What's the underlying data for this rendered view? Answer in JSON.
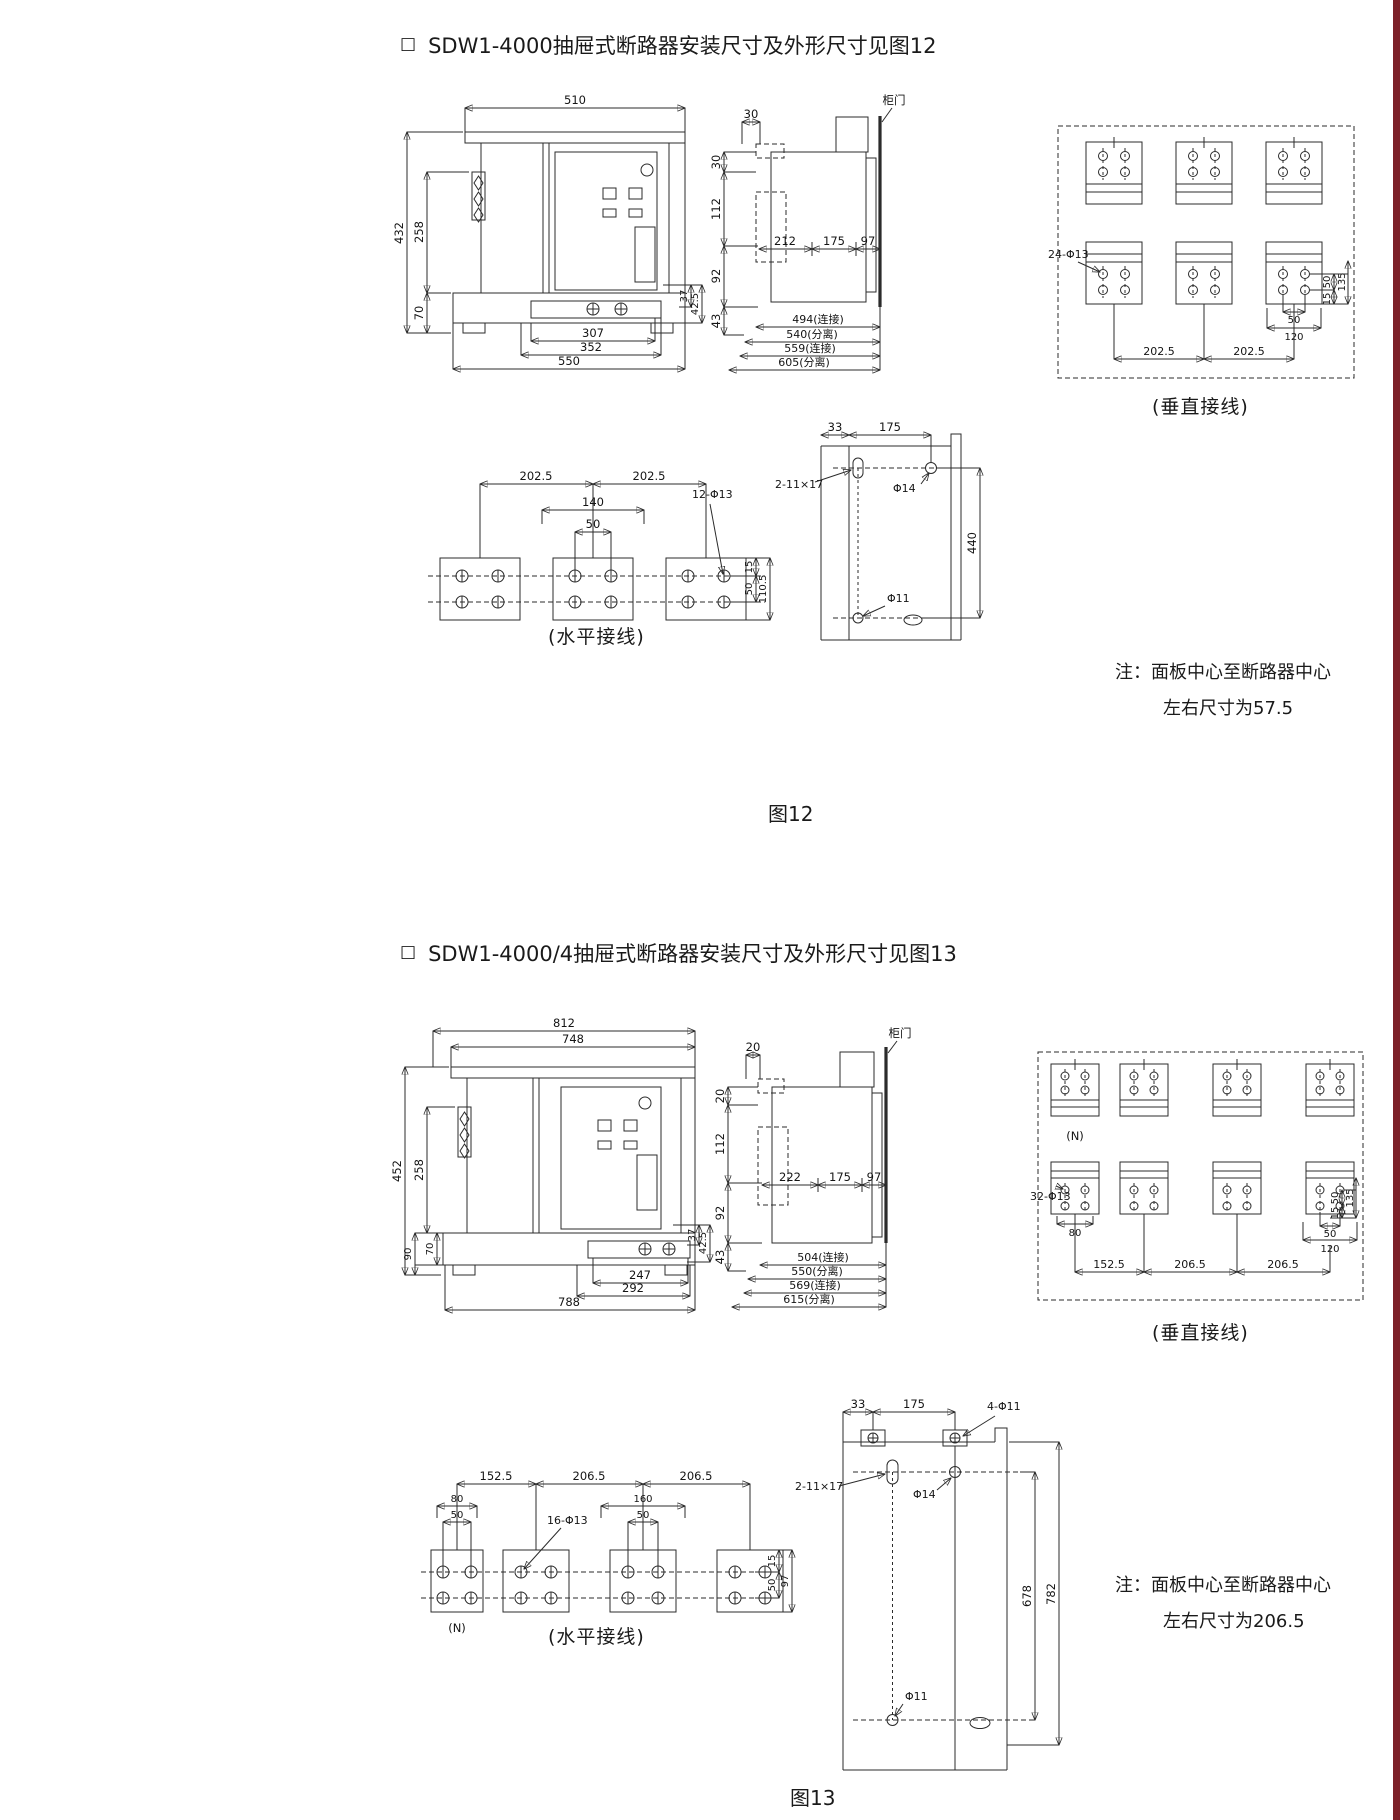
{
  "page": {
    "right_bar_color": "#7d2129"
  },
  "fig12": {
    "bullet": "□",
    "heading": "SDW1-4000抽屉式断路器安装尺寸及外形尺寸见图12",
    "caption": "图12",
    "note1": "注：面板中心至断路器中心",
    "note2": "左右尺寸为57.5",
    "front": {
      "w510": "510",
      "h432": "432",
      "h258": "258",
      "h70": "70",
      "b307": "307",
      "b352": "352",
      "b550": "550",
      "r37": "37",
      "r425": "42.5"
    },
    "side": {
      "door": "柜门",
      "t30": "30",
      "l30": "30",
      "l112": "112",
      "l92": "92",
      "l43": "43",
      "m212": "212",
      "m175": "175",
      "m97": "97",
      "b494": "494(连接)",
      "b540": "540(分离)",
      "b559": "559(连接)",
      "b605": "605(分离)"
    },
    "vert": {
      "label": "(垂直接线)",
      "holes": "24-Φ13",
      "s50": "50",
      "s15": "15",
      "s135": "135",
      "b50": "50",
      "b120": "120",
      "p1": "202.5",
      "p2": "202.5"
    },
    "horiz": {
      "label": "(水平接线)",
      "holes": "12-Φ13",
      "p1": "202.5",
      "p2": "202.5",
      "w140": "140",
      "w50": "50",
      "r15": "15",
      "r50": "50",
      "r110": "110.5"
    },
    "cut": {
      "t33": "33",
      "t175": "175",
      "slot": "2-11×17",
      "p14": "Φ14",
      "p11": "Φ11",
      "h440": "440"
    }
  },
  "fig13": {
    "bullet": "□",
    "heading": "SDW1-4000/4抽屉式断路器安装尺寸及外形尺寸见图13",
    "caption": "图13",
    "note1": "注：面板中心至断路器中心",
    "note2": "左右尺寸为206.5",
    "front": {
      "w812": "812",
      "w748": "748",
      "h452": "452",
      "h258": "258",
      "h90": "90",
      "h70": "70",
      "b247": "247",
      "b292": "292",
      "b788": "788",
      "r37": "37",
      "r425": "42.5"
    },
    "side": {
      "door": "柜门",
      "t20": "20",
      "l20": "20",
      "l112": "112",
      "l92": "92",
      "l43": "43",
      "m222": "222",
      "m175": "175",
      "m97": "97",
      "b504": "504(连接)",
      "b550": "550(分离)",
      "b569": "569(连接)",
      "b615": "615(分离)"
    },
    "vert": {
      "label": "(垂直接线)",
      "n": "(N)",
      "holes": "32-Φ13",
      "w80": "80",
      "p1": "152.5",
      "p2": "206.5",
      "p3": "206.5",
      "r50": "50",
      "r15": "15",
      "r135": "135",
      "b50": "50",
      "b120": "120"
    },
    "horiz": {
      "label": "(水平接线)",
      "n": "(N)",
      "p1": "152.5",
      "p2": "206.5",
      "p3": "206.5",
      "w80": "80",
      "w50a": "50",
      "holes": "16-Φ13",
      "w160": "160",
      "w50b": "50",
      "r15": "15",
      "r50": "50",
      "r97": "97"
    },
    "cut": {
      "t33": "33",
      "t175": "175",
      "corner": "4-Φ11",
      "slot": "2-11×17",
      "p14": "Φ14",
      "p11": "Φ11",
      "h678": "678",
      "h782": "782"
    }
  }
}
